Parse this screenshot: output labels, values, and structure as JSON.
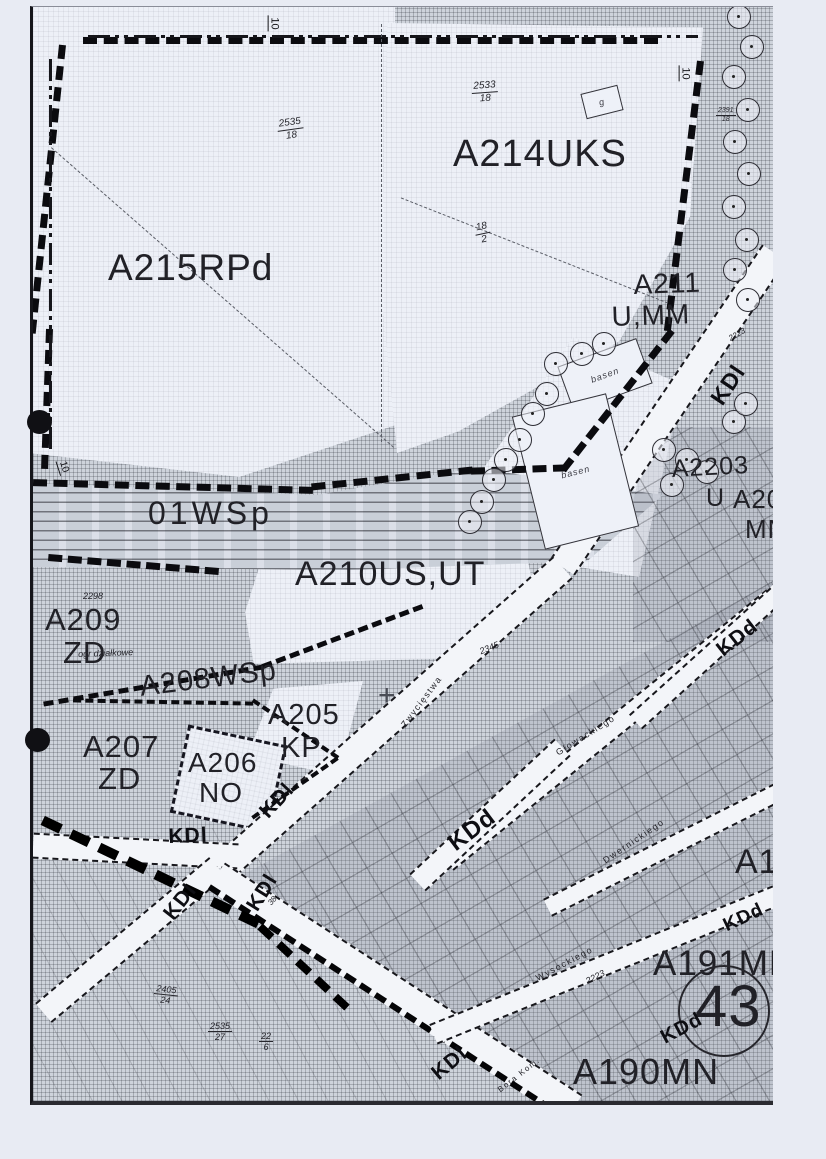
{
  "zones": {
    "a215": "A215RPd",
    "a214": "A214UKS",
    "a211a": "A211",
    "a211b": "U,MM",
    "wsp01": "01WSp",
    "a210": "A210US,UT",
    "a209a": "A209",
    "a209b": "ZD",
    "a209note": "ogr działkowe",
    "a208": "A208WSp",
    "a205a": "A205",
    "a205b": "KP",
    "a207a": "A207",
    "a207b": "ZD",
    "a206a": "A206",
    "a206b": "NO",
    "a220a": "A2203",
    "a220b": "U",
    "a204a": "A204",
    "a204b": "MN",
    "a19": "A19",
    "a191": "A191MN",
    "a190": "A190MN",
    "n43": "43"
  },
  "roads": {
    "kdl": "KDl",
    "kdd": "KDd"
  },
  "streets": {
    "zwyciestwa": "Zwycięstwa",
    "glowackiego": "Głowackiego",
    "dwernickiego": "Dwernickiego",
    "wysockiego": "Wysockiego",
    "bora": "Bora Kom."
  },
  "parcels": {
    "p2535_18": {
      "n": "2535",
      "d": "18"
    },
    "p2533_18": {
      "n": "2533",
      "d": "18"
    },
    "p18_2": {
      "n": "18",
      "d": "2"
    },
    "p2391_18": {
      "n": "2391",
      "d": "18"
    },
    "p2405_24": {
      "n": "2405",
      "d": "24"
    },
    "p2535_27": {
      "n": "2535",
      "d": "27"
    },
    "p22_6": {
      "n": "22",
      "d": "6"
    },
    "n2223": "2223",
    "n2298": "2298",
    "n2345": "2345",
    "n38": "38"
  },
  "markers": {
    "ten": "10",
    "g": "g",
    "basen": "basen",
    "cross": "+"
  },
  "colors": {
    "paper": "#e8ebf3",
    "ink": "#1e1e22",
    "hatch": "#ced3db",
    "light": "#edf0f7",
    "road": "#f3f5f9"
  }
}
